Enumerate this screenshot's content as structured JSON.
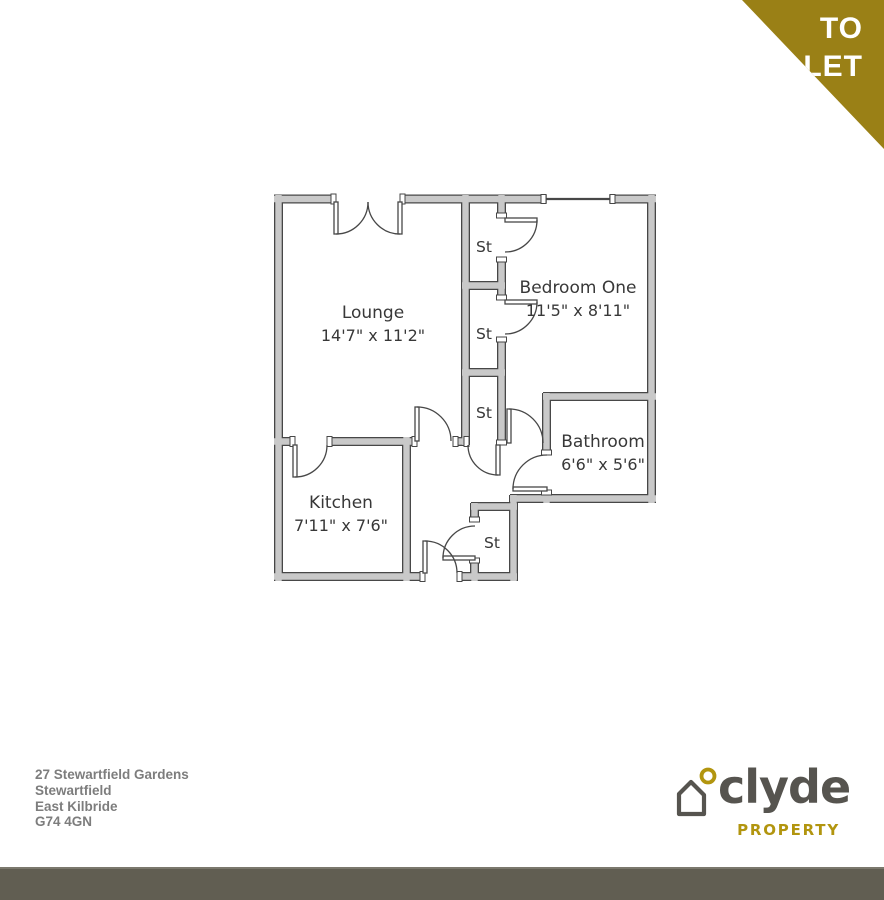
{
  "banner": {
    "line1": "TO",
    "line2": "LET",
    "background_color": "#9a8016",
    "text_color": "#ffffff"
  },
  "plan": {
    "rooms": [
      {
        "name": "Lounge",
        "dims": "14'7\" x 11'2\""
      },
      {
        "name": "Bedroom One",
        "dims": "11'5\" x 8'11\""
      },
      {
        "name": "Bathroom",
        "dims": "6'6\" x 5'6\""
      },
      {
        "name": "Kitchen",
        "dims": "7'11\" x 7'6\""
      }
    ],
    "storage_label": "St",
    "wall_fill_color": "#c9c9c9",
    "wall_line_color": "#474747",
    "text_color": "#383838"
  },
  "address": {
    "lines": [
      "27 Stewartfield Gardens",
      "Stewartfield",
      "East Kilbride",
      "G74 4GN"
    ]
  },
  "logo": {
    "brand": "clyde",
    "tagline": "PROPERTY",
    "gold_color": "#b2950f",
    "gray_color": "#56544f"
  },
  "footer": {
    "bar_color": "#615e52"
  }
}
